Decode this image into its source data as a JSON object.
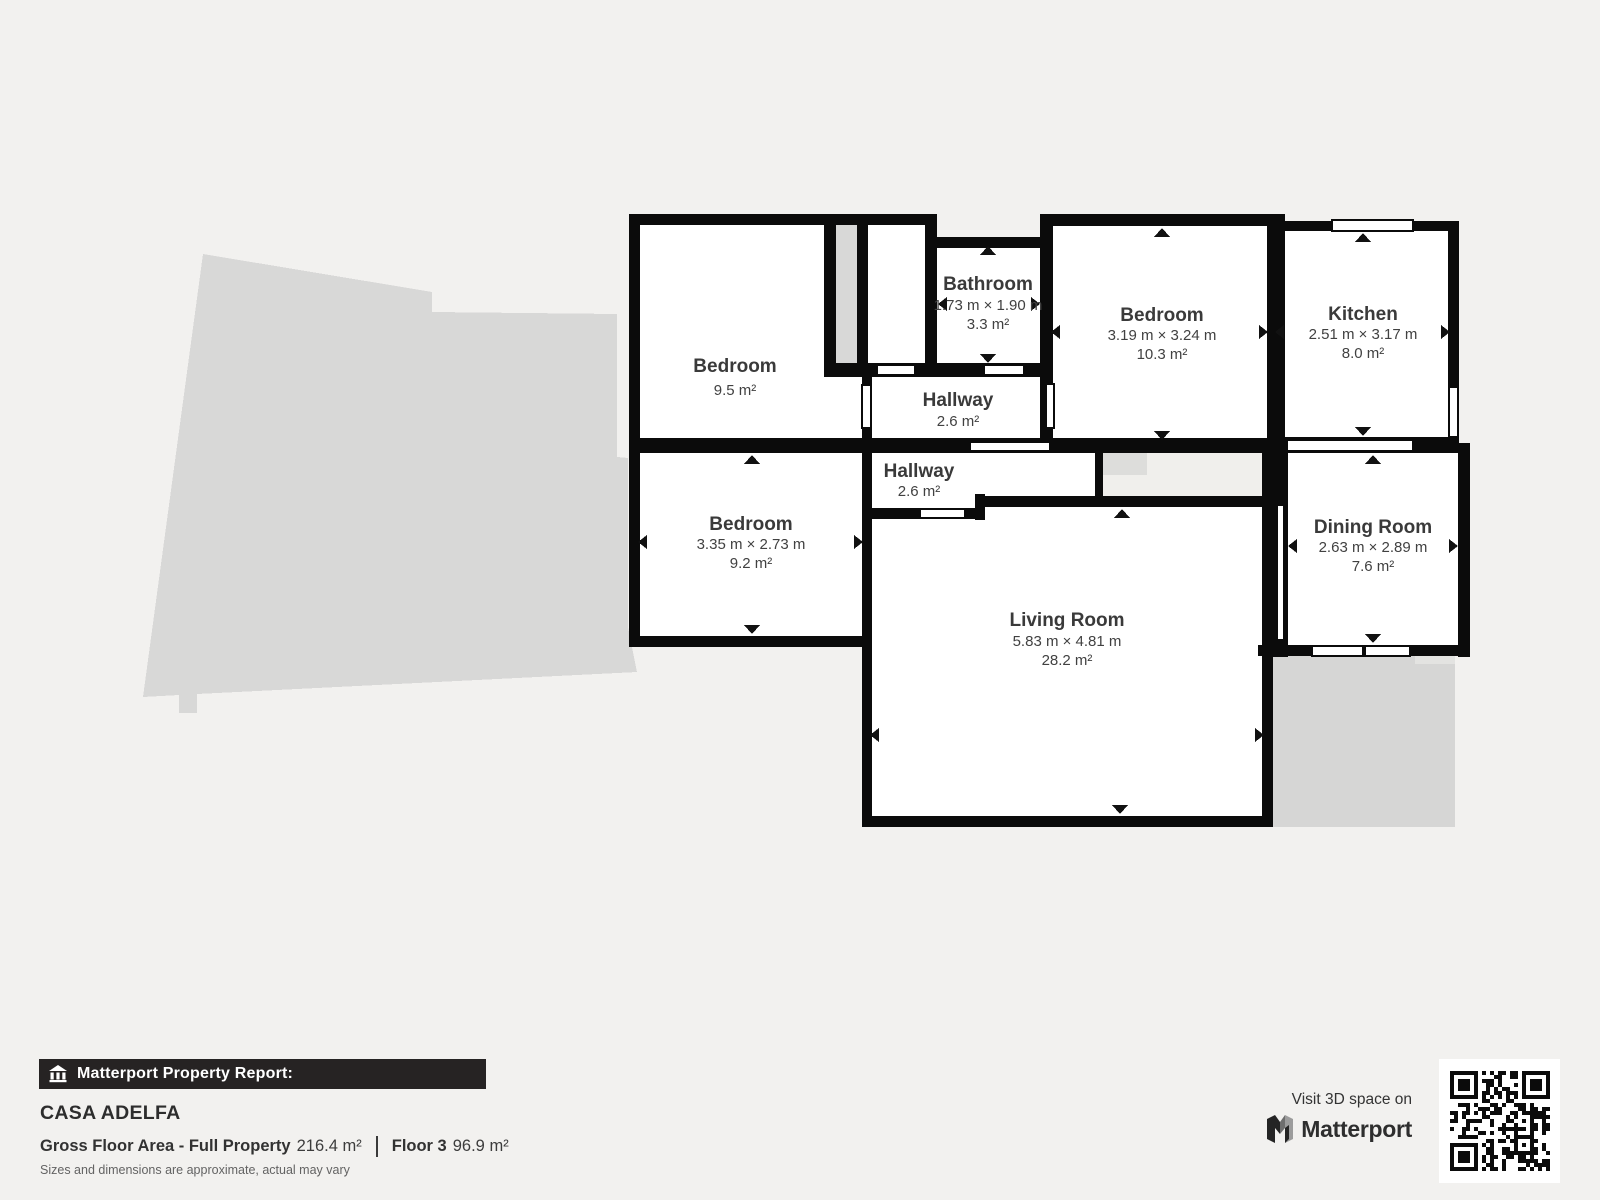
{
  "floorplan": {
    "rooms": [
      {
        "name": "Bedroom",
        "dims": "",
        "area": "9.5 m²"
      },
      {
        "name": "Bathroom",
        "dims": "1.73 m × 1.90 m",
        "area": "3.3 m²"
      },
      {
        "name": "Bedroom",
        "dims": "3.19 m × 3.24 m",
        "area": "10.3 m²"
      },
      {
        "name": "Kitchen",
        "dims": "2.51 m × 3.17 m",
        "area": "8.0 m²"
      },
      {
        "name": "Hallway",
        "dims": "",
        "area": "2.6 m²"
      },
      {
        "name": "Hallway",
        "dims": "",
        "area": "2.6 m²"
      },
      {
        "name": "Bedroom",
        "dims": "3.35 m × 2.73 m",
        "area": "9.2 m²"
      },
      {
        "name": "Dining Room",
        "dims": "2.63 m × 2.89 m",
        "area": "7.6 m²"
      },
      {
        "name": "Living Room",
        "dims": "5.83 m × 4.81 m",
        "area": "28.2 m²"
      }
    ]
  },
  "report": {
    "bar_label": "Matterport Property Report:",
    "property_name": "CASA ADELFA",
    "gfa_label": "Gross Floor Area - Full Property",
    "gfa_value": "216.4 m²",
    "floor_label": "Floor 3",
    "floor_value": "96.9 m²",
    "disclaimer": "Sizes and dimensions are approximate, actual may vary"
  },
  "cta": {
    "visit_text": "Visit 3D space on",
    "brand": "Matterport"
  },
  "colors": {
    "page_bg": "#f2f1ef",
    "wall": "#0b0b0b",
    "silhouette": "#d8d8d7",
    "bar_bg": "#262323"
  }
}
